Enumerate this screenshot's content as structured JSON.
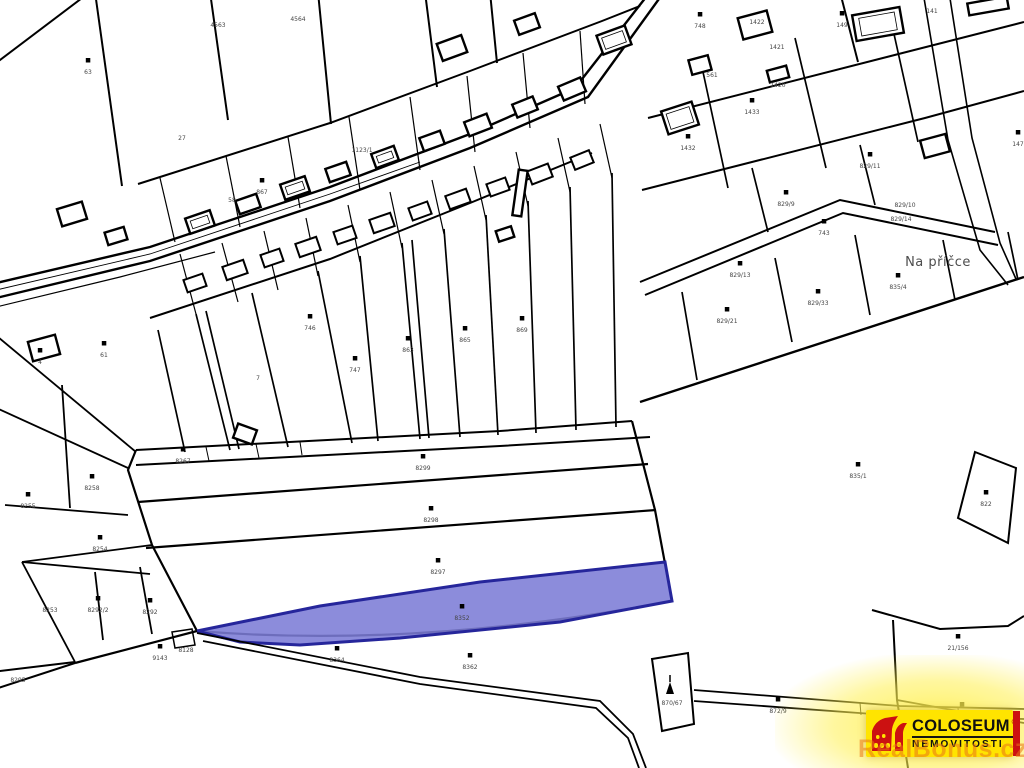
{
  "map": {
    "area_label": "Na příčce",
    "area_label_pos": {
      "x": 938,
      "y": 266
    },
    "line_color": "#000000",
    "label_color": "#454545",
    "highlight": {
      "parcel_label": "8352",
      "fill": "#7c7cd6",
      "fill_opacity": 0.88,
      "stroke": "#26269b",
      "stroke_width": 3,
      "points": "197,631 320,606 480,582 665,562 672,601 560,622 400,638 300,645 240,642"
    },
    "parcels": [
      {
        "label": "8299",
        "x": 423,
        "y": 470
      },
      {
        "label": "8298",
        "x": 431,
        "y": 522
      },
      {
        "label": "8297",
        "x": 438,
        "y": 574
      },
      {
        "label": "8352",
        "x": 462,
        "y": 620
      },
      {
        "label": "835/1",
        "x": 858,
        "y": 478
      },
      {
        "label": "822",
        "x": 986,
        "y": 506
      },
      {
        "label": "829/21",
        "x": 727,
        "y": 323
      },
      {
        "label": "829/33",
        "x": 818,
        "y": 305
      },
      {
        "label": "835/4",
        "x": 898,
        "y": 289
      },
      {
        "label": "829/11",
        "x": 870,
        "y": 168
      },
      {
        "label": "829/9",
        "x": 786,
        "y": 206
      },
      {
        "label": "829/13",
        "x": 740,
        "y": 277
      },
      {
        "label": "829/10",
        "x": 905,
        "y": 207,
        "m": "none"
      },
      {
        "label": "829/14",
        "x": 901,
        "y": 221,
        "m": "none"
      },
      {
        "label": "21/156",
        "x": 958,
        "y": 650
      },
      {
        "label": "8332",
        "x": 962,
        "y": 718
      },
      {
        "label": "872/9",
        "x": 778,
        "y": 713
      },
      {
        "label": "870/67",
        "x": 672,
        "y": 705,
        "m": "none"
      },
      {
        "label": "8364",
        "x": 337,
        "y": 662
      },
      {
        "label": "8362",
        "x": 470,
        "y": 669
      },
      {
        "label": "8295",
        "x": 18,
        "y": 682,
        "m": "none"
      },
      {
        "label": "8292",
        "x": 150,
        "y": 614
      },
      {
        "label": "8292/2",
        "x": 98,
        "y": 612
      },
      {
        "label": "9143",
        "x": 160,
        "y": 660
      },
      {
        "label": "8128",
        "x": 186,
        "y": 652,
        "m": "none"
      },
      {
        "label": "8258",
        "x": 92,
        "y": 490
      },
      {
        "label": "8255",
        "x": 28,
        "y": 508
      },
      {
        "label": "8254",
        "x": 100,
        "y": 551
      },
      {
        "label": "8253",
        "x": 50,
        "y": 612,
        "m": "none"
      },
      {
        "label": "8267",
        "x": 183,
        "y": 463
      },
      {
        "label": "63",
        "x": 88,
        "y": 74
      },
      {
        "label": "61",
        "x": 104,
        "y": 357
      },
      {
        "label": "4",
        "x": 40,
        "y": 364
      },
      {
        "label": "7",
        "x": 258,
        "y": 380,
        "m": "none"
      },
      {
        "label": "746",
        "x": 310,
        "y": 330
      },
      {
        "label": "747",
        "x": 355,
        "y": 372
      },
      {
        "label": "863",
        "x": 408,
        "y": 352
      },
      {
        "label": "865",
        "x": 465,
        "y": 342
      },
      {
        "label": "869",
        "x": 522,
        "y": 332
      },
      {
        "label": "748",
        "x": 700,
        "y": 28
      },
      {
        "label": "1422",
        "x": 757,
        "y": 24,
        "m": "none"
      },
      {
        "label": "1421",
        "x": 777,
        "y": 49,
        "m": "none"
      },
      {
        "label": "1420",
        "x": 778,
        "y": 87,
        "m": "none"
      },
      {
        "label": "1432",
        "x": 688,
        "y": 150
      },
      {
        "label": "1433",
        "x": 752,
        "y": 114
      },
      {
        "label": "561",
        "x": 712,
        "y": 77,
        "m": "none"
      },
      {
        "label": "149",
        "x": 842,
        "y": 27
      },
      {
        "label": "141",
        "x": 932,
        "y": 13,
        "m": "none"
      },
      {
        "label": "147",
        "x": 1018,
        "y": 146
      },
      {
        "label": "743",
        "x": 824,
        "y": 235
      },
      {
        "label": "1123/1",
        "x": 362,
        "y": 152,
        "m": "none"
      },
      {
        "label": "27",
        "x": 182,
        "y": 140,
        "m": "none"
      },
      {
        "label": "58",
        "x": 232,
        "y": 202,
        "m": "none"
      },
      {
        "label": "4563",
        "x": 218,
        "y": 27,
        "m": "none"
      },
      {
        "label": "4564",
        "x": 298,
        "y": 21,
        "m": "none"
      },
      {
        "label": "867",
        "x": 262,
        "y": 194
      }
    ]
  },
  "logo": {
    "brand": "COLOSEUM",
    "registered": "®",
    "subtitle": "NEMOVITOSTI",
    "watermark": "RealBonus.cz",
    "bg_color": "#ffe400",
    "accent_color": "#cc1111"
  }
}
